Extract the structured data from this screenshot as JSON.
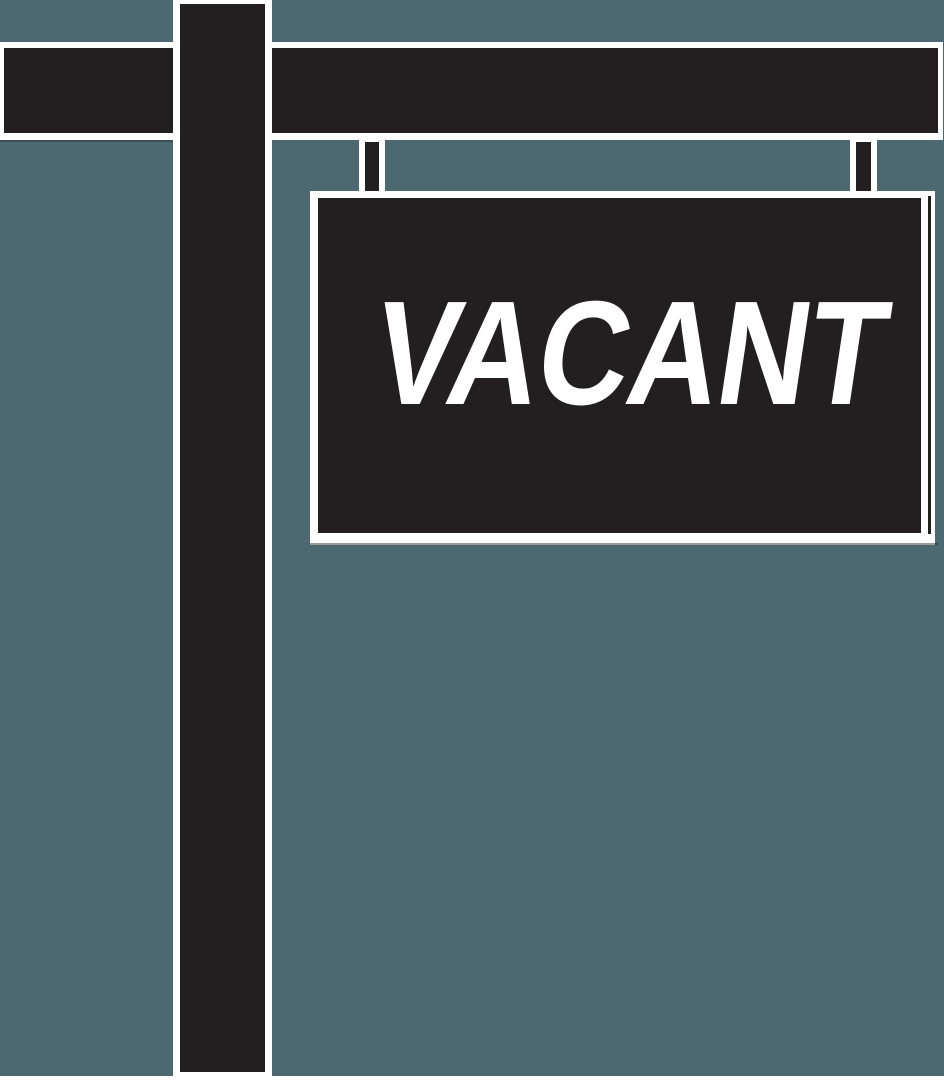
{
  "sign": {
    "label": "VACANT"
  },
  "colors": {
    "background": "#4c6972",
    "shape": "#231f20",
    "outline": "#ffffff",
    "text": "#ffffff"
  }
}
